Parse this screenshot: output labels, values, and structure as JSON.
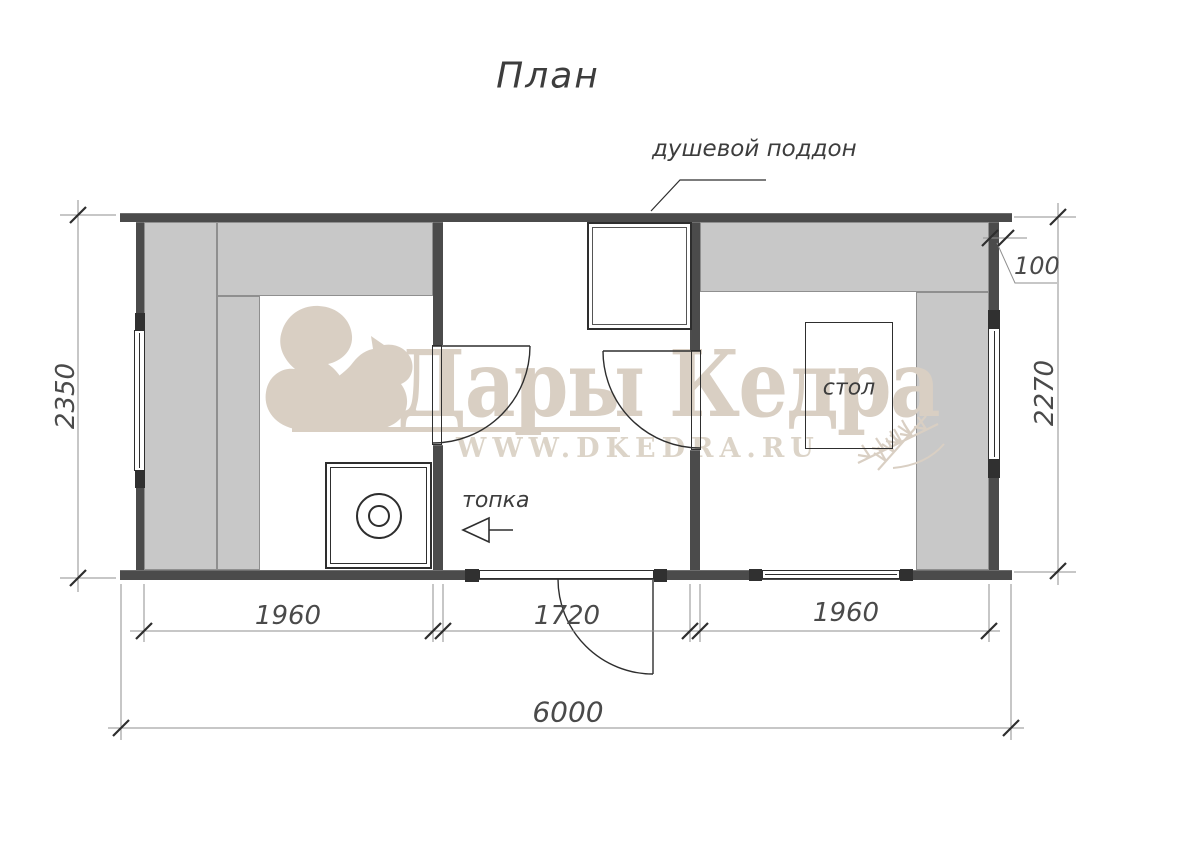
{
  "title": "План",
  "labels": {
    "shower_tray": "душевой поддон",
    "firebox": "топка",
    "table": "стол"
  },
  "dimensions": {
    "total_width": "6000",
    "left_height": "2350",
    "right_height": "2270",
    "wall_thickness": "100",
    "rooms": [
      "1960",
      "1720",
      "1960"
    ]
  },
  "watermark": {
    "brand": "Дары Кедра",
    "url": "WWW.DKEDRA.RU",
    "color": "#d9cfc3"
  },
  "colors": {
    "wall": "#4b4b4b",
    "wall_block": "#303030",
    "bench": "#c8c8c8",
    "line": "#2e2e2e",
    "dim_line": "#8f8f8f",
    "text": "#3d3d3d"
  }
}
